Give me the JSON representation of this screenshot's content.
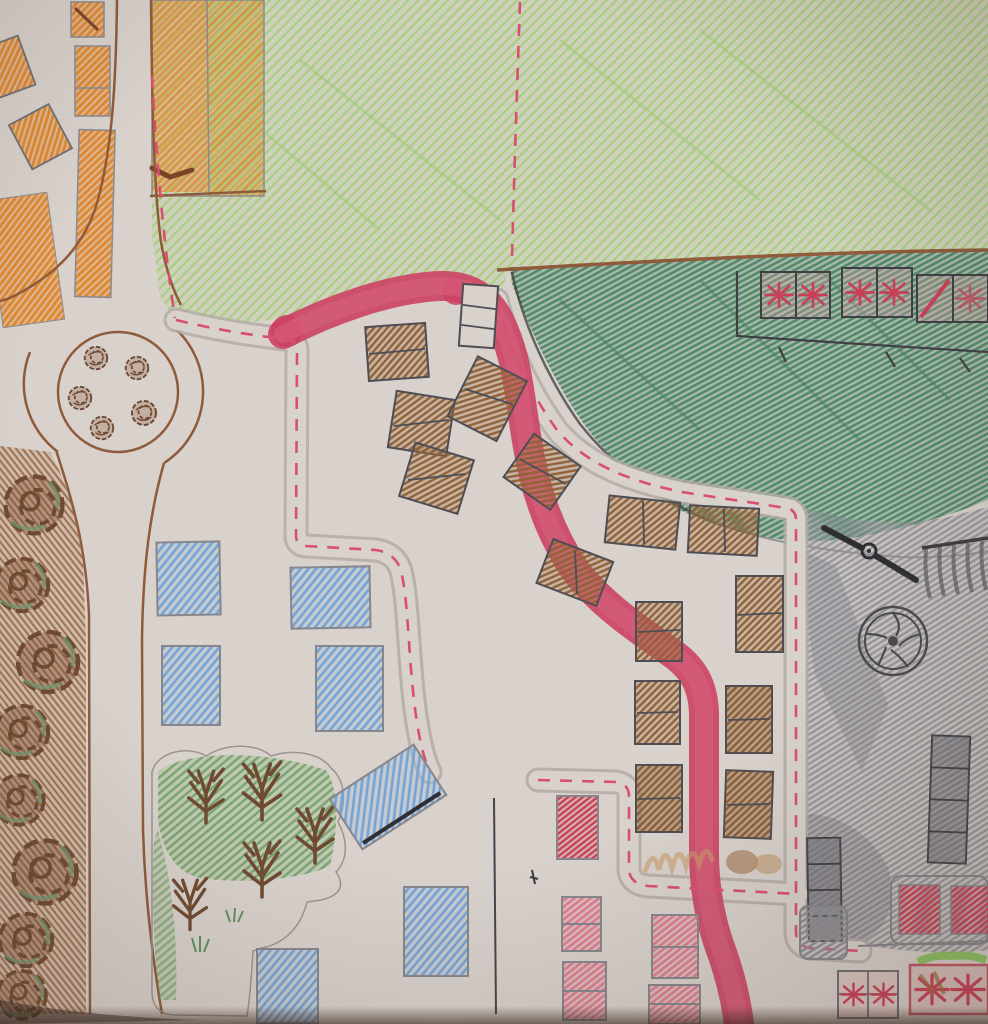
{
  "title": "Hand-drawn town map in colored pencil on paper",
  "canvas": {
    "width": 988,
    "height": 1024
  },
  "colors": {
    "paper": "#d8d1cc",
    "light_green": "#a8cf7f",
    "park_green": "#76a56d",
    "dark_green": "#4f8a6b",
    "orange": "#df8a34",
    "brown_road": "#8f5b3b",
    "tree_brown": "#6e4a32",
    "building_brown": "#8f6238",
    "pink_road": "#cc4163",
    "pink_road_light": "#d9627f",
    "pink_dash": "#d94f72",
    "red_building": "#c84057",
    "pink_building": "#dd7f93",
    "blue_building": "#74a3d6",
    "gray_pencil": "#8d8d94",
    "black_pencil": "#3f3f44",
    "tan": "#c89a6a"
  },
  "features": {
    "regions": [
      {
        "name": "meadow",
        "description": "light green hatched field across the top"
      },
      {
        "name": "dark-green-field",
        "description": "dark green field, top right, holding three red flag plots and a post wall"
      },
      {
        "name": "gray-lot",
        "description": "gray shaded lot on the right with propeller, wheel and striped banner"
      },
      {
        "name": "orange-district",
        "description": "orange buildings in the top-left corner"
      },
      {
        "name": "tree-row",
        "description": "column of round scribbled trees along the left road"
      },
      {
        "name": "park",
        "description": "park with bare branching trees, bottom left"
      }
    ],
    "roads": [
      {
        "name": "main-road",
        "style": "thick pink crayon S-curve"
      },
      {
        "name": "ring-road",
        "style": "brown outlined roads with central roundabout"
      },
      {
        "name": "residential-roads",
        "style": "gray pencil roads with pink dashed centerlines"
      }
    ],
    "landmarks": [
      {
        "name": "roundabout",
        "shrubs": 5
      },
      {
        "name": "propeller",
        "blades": 2
      },
      {
        "name": "wheel",
        "spokes": 5
      },
      {
        "name": "striped-banner",
        "stripes": 5
      },
      {
        "name": "flag-plots",
        "count": 3
      },
      {
        "name": "segment-wall",
        "posts": 3
      }
    ],
    "building_counts": {
      "blue": 7,
      "brown": 14,
      "white": 1,
      "pink_red": 5,
      "gray_towers": 2,
      "orange": 7,
      "starburst_bottom_right": 2
    }
  }
}
